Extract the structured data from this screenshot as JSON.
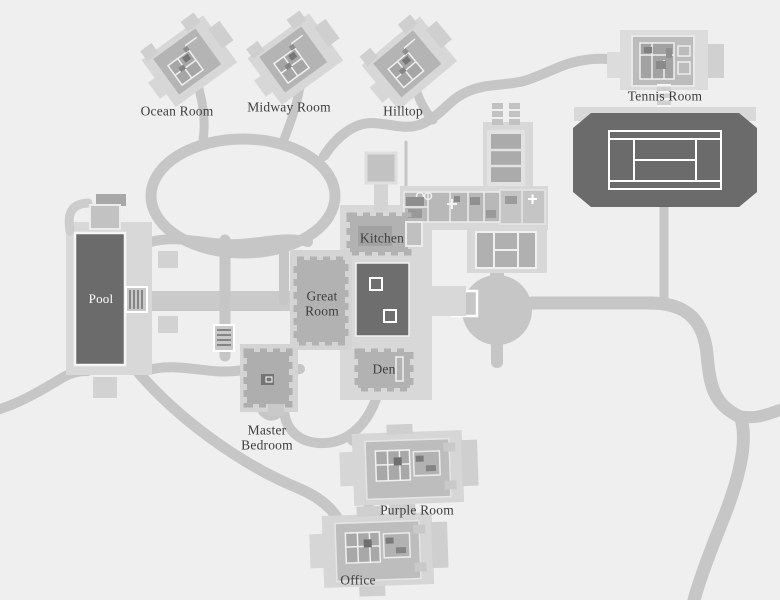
{
  "map": {
    "locations": {
      "ocean_room": {
        "label": "Ocean Room"
      },
      "midway_room": {
        "label": "Midway Room"
      },
      "hilltop": {
        "label": "Hilltop"
      },
      "tennis_room": {
        "label": "Tennis Room"
      },
      "pool": {
        "label": "Pool"
      },
      "kitchen": {
        "label": "Kitchen"
      },
      "great_room": {
        "label": "Great Room"
      },
      "den": {
        "label": "Den"
      },
      "master_bedroom": {
        "label": "Master Bedroom"
      },
      "purple_room": {
        "label": "Purple Room"
      },
      "office": {
        "label": "Office"
      }
    },
    "colors": {
      "background": "#efefef",
      "road": "#c6c6c6",
      "platform": "#d8d8d8",
      "building": "#b4b4b4",
      "dark_feature": "#6b6b6b",
      "court_lines": "#ffffff",
      "label_text": "#3e3e3e",
      "pool_label_text": "#ffffff"
    }
  }
}
